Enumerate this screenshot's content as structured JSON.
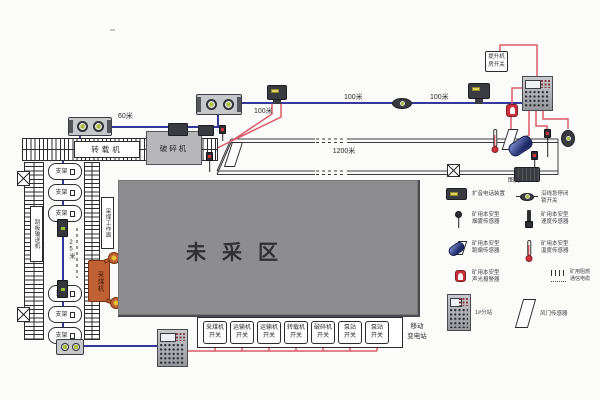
{
  "top_line": {
    "distances": {
      "d60": "60米",
      "d100_a": "100米",
      "d100_b": "100米",
      "d100_c": "100米"
    }
  },
  "hoist_box": {
    "line1": "提升机",
    "line2": "房开关"
  },
  "belt": {
    "distance": "1200米"
  },
  "face": {
    "transfer_label": "转载机",
    "crusher_label": "破碎机",
    "support_label": "支架",
    "shearer_label": "采煤机",
    "left_strip": "刮板输送机",
    "right_strip": "采煤工作面",
    "spacing": "25米"
  },
  "unmined": {
    "label": "未采区"
  },
  "bottom_panel": {
    "switches": [
      {
        "line1": "采煤机",
        "line2": "开关"
      },
      {
        "line1": "运输机",
        "line2": "开关"
      },
      {
        "line1": "运输机",
        "line2": "开关"
      },
      {
        "line1": "转载机",
        "line2": "开关"
      },
      {
        "line1": "破碎机",
        "line2": "开关"
      },
      {
        "line1": "泵站",
        "line2": "开关"
      },
      {
        "line1": "泵站",
        "line2": "开关"
      }
    ],
    "substation_line1": "移动",
    "substation_line2": "变电站"
  },
  "legend": {
    "title": "图例",
    "left": [
      {
        "icon": "voice-phone-icon",
        "lines": [
          "扩音电话装置"
        ]
      },
      {
        "icon": "smoke-sensor-icon",
        "lines": [
          "矿用本安型",
          "烟雾传感器"
        ]
      },
      {
        "icon": "belt-drift-sensor-icon",
        "lines": [
          "矿用本安型",
          "跑偏传感器"
        ]
      },
      {
        "icon": "alarm-icon",
        "lines": [
          "矿用本安型",
          "声光报警器"
        ]
      }
    ],
    "right": [
      {
        "icon": "pull-wire-switch-icon",
        "lines": [
          "沿线急停闭",
          "锁开关"
        ]
      },
      {
        "icon": "speed-sensor-icon",
        "lines": [
          "矿用本安型",
          "速度传感器"
        ]
      },
      {
        "icon": "temperature-sensor-icon",
        "lines": [
          "矿用本安型",
          "温度传感器"
        ]
      },
      {
        "icon": "cable-icon",
        "lines": [
          "矿用阻燃",
          "通信电缆"
        ]
      }
    ],
    "bottom": [
      {
        "icon": "substation-icon",
        "lines": [
          "1#分站"
        ]
      },
      {
        "icon": "air-door-sensor-icon",
        "lines": [
          "风门传感器"
        ]
      }
    ]
  },
  "colors": {
    "line_blue": "#35389b",
    "line_red": "#dd5a68",
    "unmined_gray": "#8d8d90",
    "shearer_orange": "#bf6134"
  }
}
